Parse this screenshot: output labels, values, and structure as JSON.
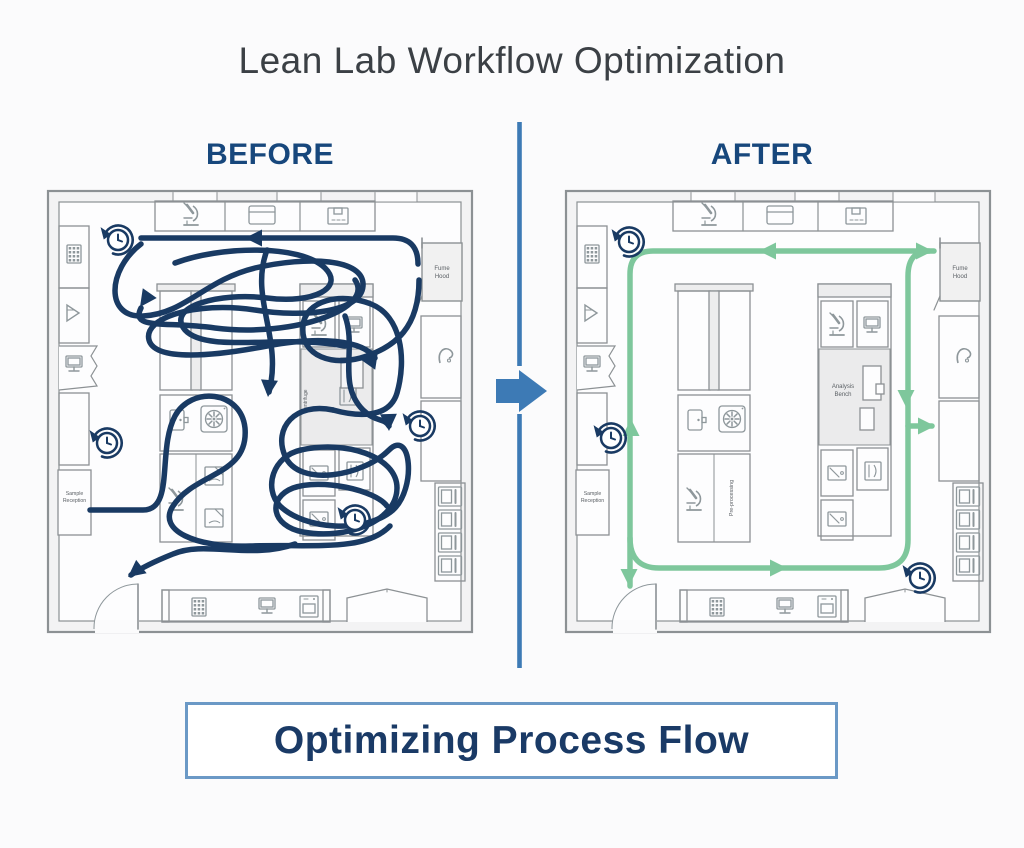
{
  "title": "Lean Lab Workflow Optimization",
  "panels": {
    "before": {
      "label": "BEFORE"
    },
    "after": {
      "label": "AFTER"
    }
  },
  "banner": {
    "text": "Optimizing Process Flow"
  },
  "colors": {
    "navy_flow": "#193a63",
    "green_flow": "#7ec79c",
    "accent_blue": "#3d7ab5",
    "heading_navy": "#17477c",
    "title_gray": "#3b4045",
    "wall_gray": "#8c9194",
    "furniture_gray": "#8e979b",
    "banner_border": "#6b99c6",
    "banner_text": "#1a3a66",
    "label_gray": "#5b6065"
  },
  "floorplan_labels": {
    "fume_hood_line1": "Fume",
    "fume_hood_line2": "Hood",
    "sample_line1": "Sample",
    "sample_line2": "Reception",
    "analysis_line1": "Analysis",
    "analysis_line2": "Bench",
    "pre_processing": "Pre-processing",
    "centrifuge": "Centrifuge"
  },
  "icons": [
    "microscope-icon",
    "cabinet-icon",
    "box-icon",
    "keypad-icon",
    "funnel-icon",
    "monitor-icon",
    "printer-icon",
    "fan-icon",
    "small-door-icon",
    "page-icon",
    "faucet-icon",
    "drawer-icon",
    "sink-icon",
    "clock-history-icon",
    "door-arc"
  ],
  "before_flow": {
    "color": "#193a63",
    "width": 5.5,
    "paths": [
      "M 373,76 Q 373,50 348,50 L 96,50",
      "M 96,56 C 62,82 60,130 98,128 C 140,126 160,92 210,80 C 262,68 320,70 318,98 C 316,124 260,130 210,122 C 150,113 98,130 104,152 C 110,174 170,168 222,158 C 274,148 318,152 330,170",
      "M 130,75 C 175,58 255,56 280,80 C 300,100 268,116 222,110 C 176,104 120,118 140,142 C 162,166 240,146 300,158",
      "M 310,92 C 330,120 250,150 170,140 C 120,133 85,142 96,120",
      "M 374,92 C 374,140 350,158 322,168 C 288,180 255,168 258,138 C 260,112 296,104 326,116 C 356,128 362,170 352,205 C 344,232 310,228 288,222",
      "M 288,222 C 250,214 228,240 240,268 C 254,300 318,288 344,262 C 366,240 372,300 348,322 C 320,346 260,342 235,318 C 218,300 228,268 256,262",
      "M 256,262 C 300,252 352,268 352,300 C 352,334 300,352 258,344 C 226,338 222,310 248,300 C 276,290 330,302 342,318",
      "M 45,322 H 98 C 130,322 112,262 130,228 C 146,198 196,202 200,240 C 204,288 150,284 128,318 C 112,342 150,360 205,358 C 268,356 320,364 345,338",
      "M 222,62 C 204,110 238,150 224,204",
      "M 250,356 C 205,372 160,352 128,366 C 108,374 96,380 86,387",
      "M 300,128 C 312,160 292,196 318,222 C 330,234 340,230 344,238"
    ],
    "arrows": [
      {
        "x": 200,
        "y": 50,
        "a": 180
      },
      {
        "x": 95,
        "y": 119,
        "a": 125
      },
      {
        "x": 223,
        "y": 209,
        "a": 95
      },
      {
        "x": 333,
        "y": 163,
        "a": -55
      },
      {
        "x": 344,
        "y": 243,
        "a": 88
      },
      {
        "x": 83,
        "y": 389,
        "a": 142
      }
    ],
    "clocks": [
      [
        73,
        52
      ],
      [
        62,
        255
      ],
      [
        375,
        238
      ],
      [
        310,
        332
      ]
    ]
  },
  "after_flow": {
    "color": "#7ec79c",
    "width": 5.5,
    "paths": [
      "M 371,63 L 90,63 Q 67,63 67,86 L 67,398",
      "M 67,350 Q 67,380 96,380 L 316,380 Q 345,380 345,352 L 345,88 Q 345,63 366,63",
      "M 345,238 L 369,238"
    ],
    "arrows": [
      {
        "x": 196,
        "y": 63,
        "a": 180
      },
      {
        "x": 370,
        "y": 63,
        "a": 0
      },
      {
        "x": 343,
        "y": 219,
        "a": 90
      },
      {
        "x": 372,
        "y": 238,
        "a": 0
      },
      {
        "x": 224,
        "y": 380,
        "a": 0
      },
      {
        "x": 68,
        "y": 231,
        "a": 270
      },
      {
        "x": 66,
        "y": 398,
        "a": 90
      }
    ],
    "clocks": [
      [
        66,
        54
      ],
      [
        48,
        250
      ],
      [
        357,
        390
      ]
    ]
  },
  "divider": {
    "color": "#3d7ab5"
  }
}
